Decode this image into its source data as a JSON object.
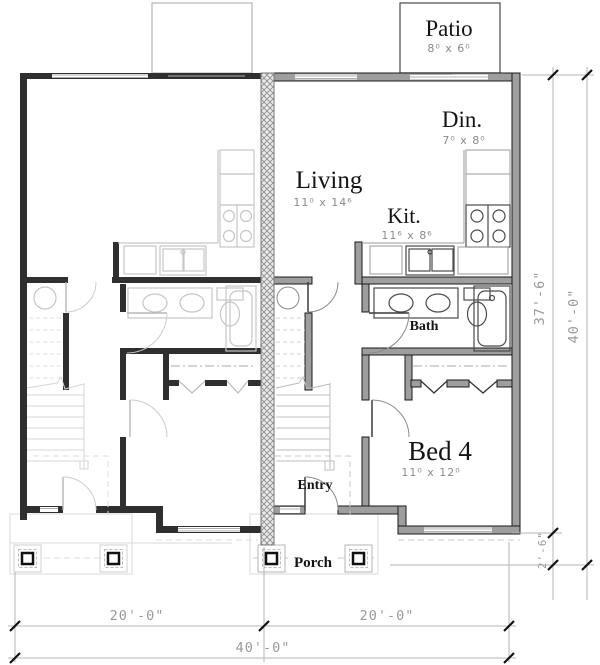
{
  "plan": {
    "rooms": {
      "patio": {
        "label": "Patio",
        "size": "8⁰ x 6⁰"
      },
      "din": {
        "label": "Din.",
        "size": "7⁰ x 8⁰"
      },
      "living": {
        "label": "Living",
        "size": "11⁰ x 14⁶"
      },
      "kit": {
        "label": "Kit.",
        "size": "11⁶ x 8⁶"
      },
      "bath": {
        "label": "Bath"
      },
      "bed4": {
        "label": "Bed 4",
        "size": "11⁰ x 12⁰"
      },
      "entry": {
        "label": "Entry"
      },
      "porch": {
        "label": "Porch"
      }
    },
    "dimensions": {
      "bottom_left": "20'-0\"",
      "bottom_right": "20'-0\"",
      "bottom_total": "40'-0\"",
      "right_upper": "37'-6\"",
      "right_total": "40'-0\"",
      "right_lower": "2'-6\""
    },
    "colors": {
      "wall_fill": "#9e9e9e",
      "wall_dark": "#2f2f2f",
      "dim_gray": "#9a9a9a"
    }
  }
}
